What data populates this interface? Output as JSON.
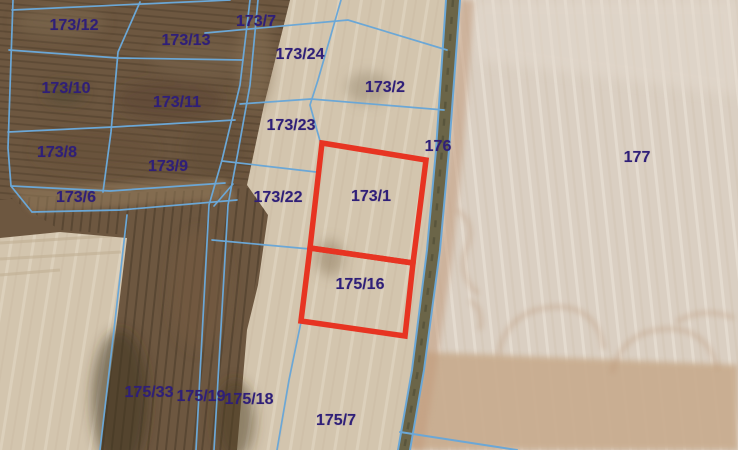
{
  "map": {
    "description": "Cadastral parcel map over satellite imagery",
    "boundary_line_color": "#6ba7d6",
    "highlight_color": "#e73422",
    "label_color": "#2f1f78",
    "labels": [
      {
        "id": "173/12",
        "x": 74,
        "y": 26
      },
      {
        "id": "173/13",
        "x": 186,
        "y": 41
      },
      {
        "id": "173/7",
        "x": 256,
        "y": 22
      },
      {
        "id": "173/24",
        "x": 300,
        "y": 55
      },
      {
        "id": "173/2",
        "x": 385,
        "y": 88
      },
      {
        "id": "173/10",
        "x": 66,
        "y": 89
      },
      {
        "id": "173/11",
        "x": 177,
        "y": 103
      },
      {
        "id": "173/23",
        "x": 291,
        "y": 126
      },
      {
        "id": "176",
        "x": 438,
        "y": 147
      },
      {
        "id": "177",
        "x": 637,
        "y": 158
      },
      {
        "id": "173/8",
        "x": 57,
        "y": 153
      },
      {
        "id": "173/9",
        "x": 168,
        "y": 167
      },
      {
        "id": "173/6",
        "x": 76,
        "y": 198
      },
      {
        "id": "173/22",
        "x": 278,
        "y": 198
      },
      {
        "id": "173/1",
        "x": 371,
        "y": 197
      },
      {
        "id": "175/16",
        "x": 360,
        "y": 285
      },
      {
        "id": "175/33",
        "x": 149,
        "y": 393
      },
      {
        "id": "175/19",
        "x": 201,
        "y": 397
      },
      {
        "id": "175/18",
        "x": 249,
        "y": 400
      },
      {
        "id": "175/7",
        "x": 336,
        "y": 421
      }
    ],
    "highlighted_parcels": [
      {
        "id": "173/1",
        "points": "322,143 426,160 413,263 310,248"
      },
      {
        "id": "175/16",
        "points": "310,248 413,263 405,336 301,321"
      }
    ]
  }
}
